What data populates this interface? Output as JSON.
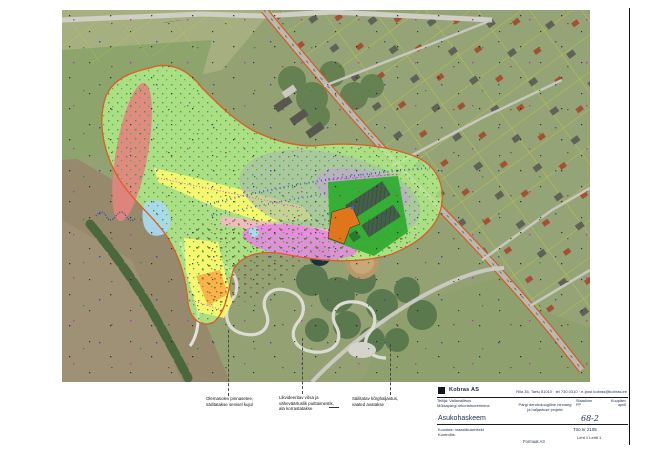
{
  "map": {
    "road_label": "···········",
    "overlay_colors": {
      "park_area_green": "#b4f08c",
      "protected_red": "#e4837f",
      "meadow_yellow": "#fdf96e",
      "wet_blue": "#a8d9ee",
      "design_magenta": "#e97fe9",
      "path_pink": "#f6b6c6",
      "new_orange": "#ffae4a",
      "canopy_grey": "#a9b7ae",
      "boundary_orange": "#d95f20",
      "cadastre_yellow": "#d6da2a",
      "buildings_green": "#2fae2f",
      "building_orange": "#e0761c"
    }
  },
  "annotations": {
    "block1": {
      "line1": "Olemasolev pinnasetee,",
      "line2": "säilitatakse senisel kujul"
    },
    "block2": {
      "line1": "Likvideeritav võsa ja",
      "line2": "väheväärtuslik puittaimestik,",
      "line3": "ala korrastatakse"
    },
    "block3": {
      "line1": "Säilitatav kõrghaljastus,",
      "line2": "vaated avatakse"
    }
  },
  "titleblock": {
    "company": "Kobras AS",
    "contact": "Riia 35, Tartu 51010 · tel 730 0310 · e-post kobras@kobras.ee",
    "project_line1": "Tellija: Vallavalitsus",
    "project_line2": "Mõisapargi rekonstrueerimine",
    "drawing_title": "Asukohaskeem",
    "middle_line1": "Pargi dendroloogiline hinnang",
    "middle_line2": "ja haljastuse projekt",
    "stage_label": "Staadium",
    "stage_value": "PP",
    "date_label": "Kuupäev",
    "date_value": "aprill",
    "sheet_code": "68-2",
    "worknr_label": "Töö nr",
    "worknr_value": "2105",
    "leht_label": "Leht",
    "leht_value": "1",
    "lehti_label": "Lehti",
    "lehti_value": "1",
    "author_line1": "Koostas: maastikuarhitekt",
    "author_line2": "Kontrollis:",
    "bottom_note": "Formaat A3"
  }
}
